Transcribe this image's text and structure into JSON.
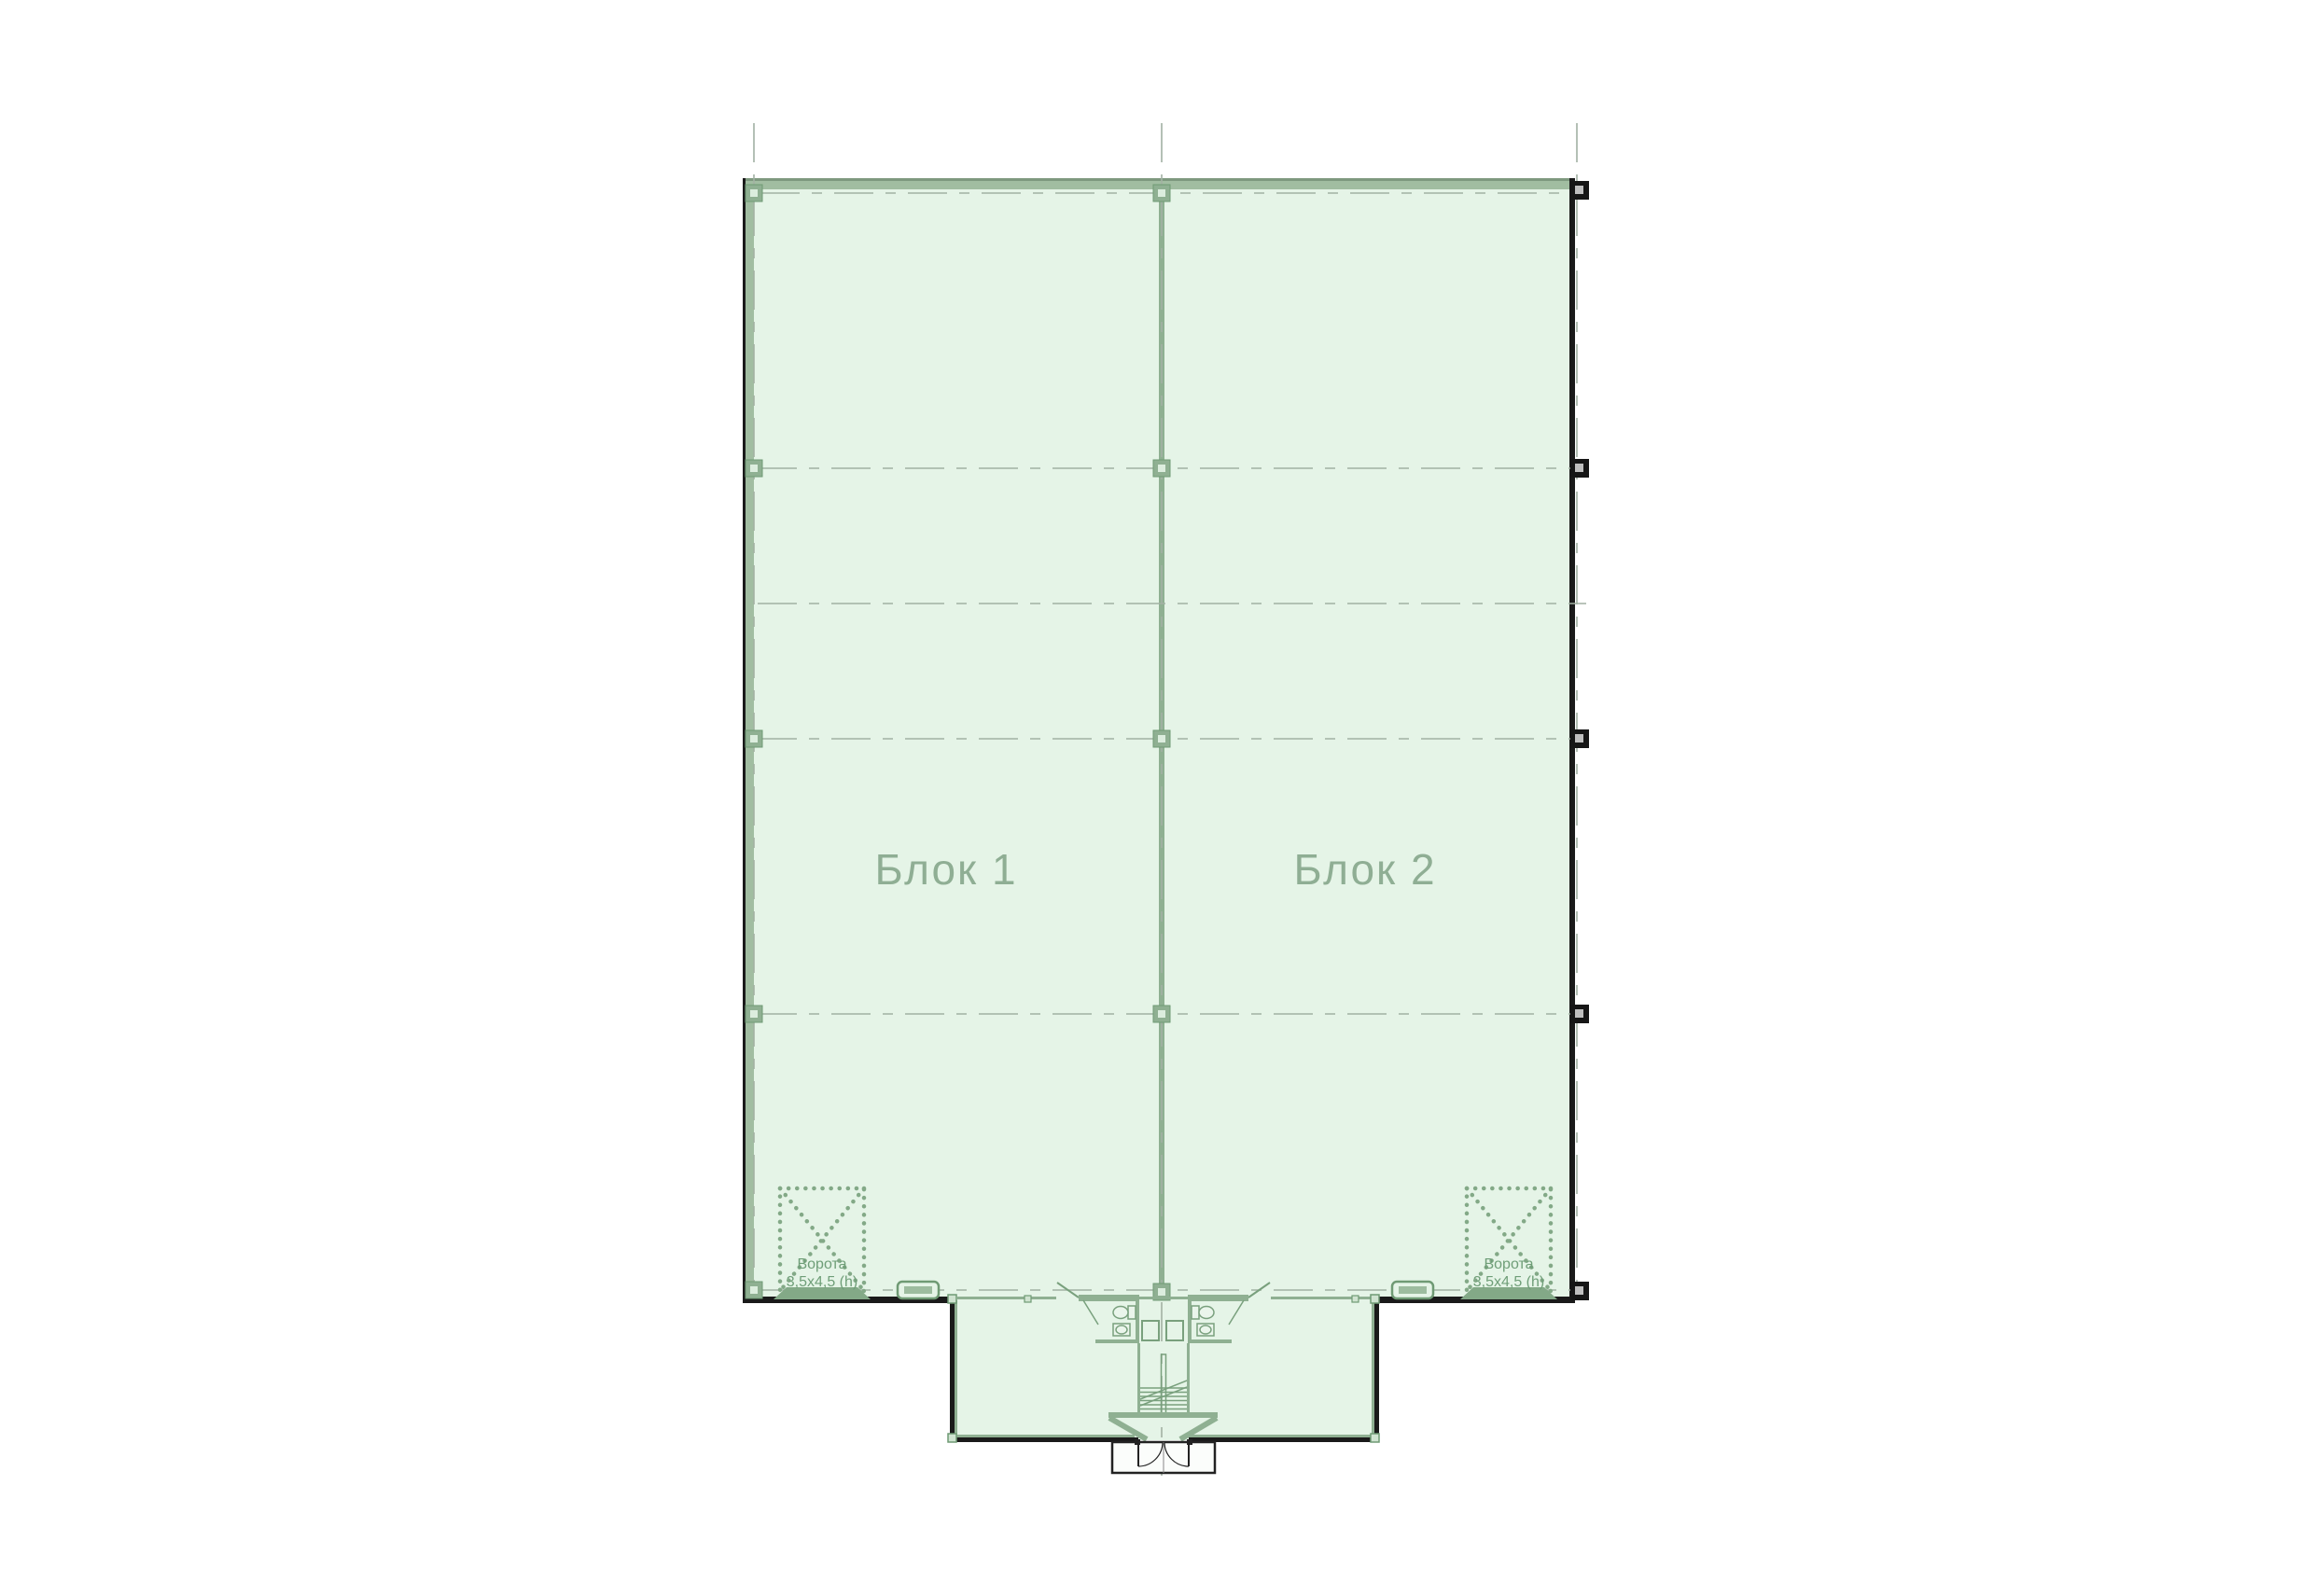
{
  "plan": {
    "block1_label": "Блок 1",
    "block2_label": "Блок 2",
    "gate_left": {
      "line1": "Ворота",
      "line2": "3,5х4,5 (h)"
    },
    "gate_right": {
      "line1": "Ворота",
      "line2": "3,5х4,5 (h)"
    }
  },
  "colors": {
    "plan_fill": "#e5f4e7",
    "wall_band_green": "#a1bda1",
    "partition_green": "#8fb092",
    "fixture_green": "#79a07d",
    "gate_green": "#83a987",
    "axis_gray": "#a2b1a3",
    "wall_black": "#1a1a1a",
    "block_label_color": "#8fae94",
    "gate_label_color": "#6f9e78",
    "column_core_gray": "#bfbfbf"
  }
}
